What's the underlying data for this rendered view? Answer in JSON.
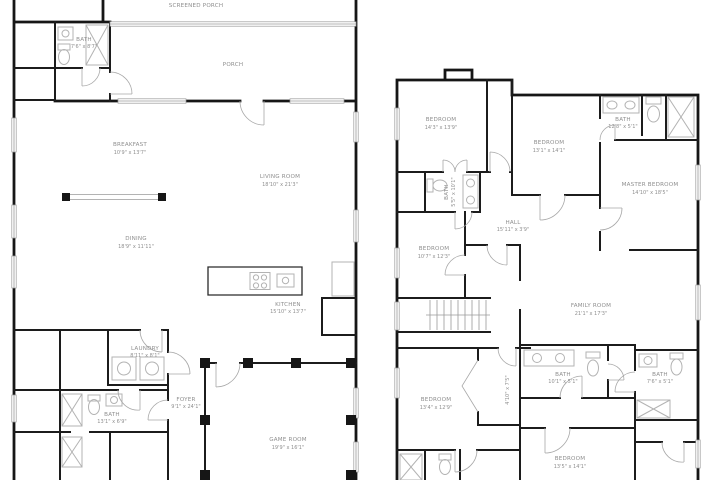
{
  "colors": {
    "wall": "#161616",
    "label": "#8f8f8f",
    "fixture": "#b3b3b3",
    "background": "#ffffff"
  },
  "first_floor": {
    "rooms": [
      {
        "name": "SCREENED PORCH",
        "dims": ""
      },
      {
        "name": "BATH",
        "dims": "7'6\" x 8'7\""
      },
      {
        "name": "PORCH",
        "dims": ""
      },
      {
        "name": "BREAKFAST",
        "dims": "10'9\" x 13'7\""
      },
      {
        "name": "LIVING ROOM",
        "dims": "18'10\" x 21'3\""
      },
      {
        "name": "DINING",
        "dims": "18'9\" x 11'11\""
      },
      {
        "name": "KITCHEN",
        "dims": "15'10\" x 13'7\""
      },
      {
        "name": "LAUNDRY",
        "dims": "8'11\" x 8'1\""
      },
      {
        "name": "BATH",
        "dims": "13'1\" x 6'9\""
      },
      {
        "name": "FOYER",
        "dims": "9'1\" x 24'1\""
      },
      {
        "name": "GAME ROOM",
        "dims": "19'9\" x 16'1\""
      }
    ]
  },
  "second_floor": {
    "rooms": [
      {
        "name": "BEDROOM",
        "dims": "14'3\" x 13'9\""
      },
      {
        "name": "BEDROOM",
        "dims": "13'1\" x 14'1\""
      },
      {
        "name": "BATH",
        "dims": "12'8\" x 5'1\""
      },
      {
        "name": "MASTER BEDROOM",
        "dims": "14'10\" x 18'5\""
      },
      {
        "name": "BATH",
        "dims": "5'5\" x 10'1\""
      },
      {
        "name": "HALL",
        "dims": "15'11\" x 3'9\""
      },
      {
        "name": "BEDROOM",
        "dims": "10'7\" x 12'3\""
      },
      {
        "name": "FAMILY ROOM",
        "dims": "21'1\" x 17'3\""
      },
      {
        "name": "BATH",
        "dims": "10'1\" x 5'1\""
      },
      {
        "name": "BATH",
        "dims": "7'6\" x 5'1\""
      },
      {
        "name": "BEDROOM",
        "dims": "13'4\" x 12'9\""
      },
      {
        "name": "BEDROOM",
        "dims": "13'5\" x 14'1\""
      },
      {
        "name": "",
        "dims": "4'10\" x 7'5\""
      }
    ]
  }
}
